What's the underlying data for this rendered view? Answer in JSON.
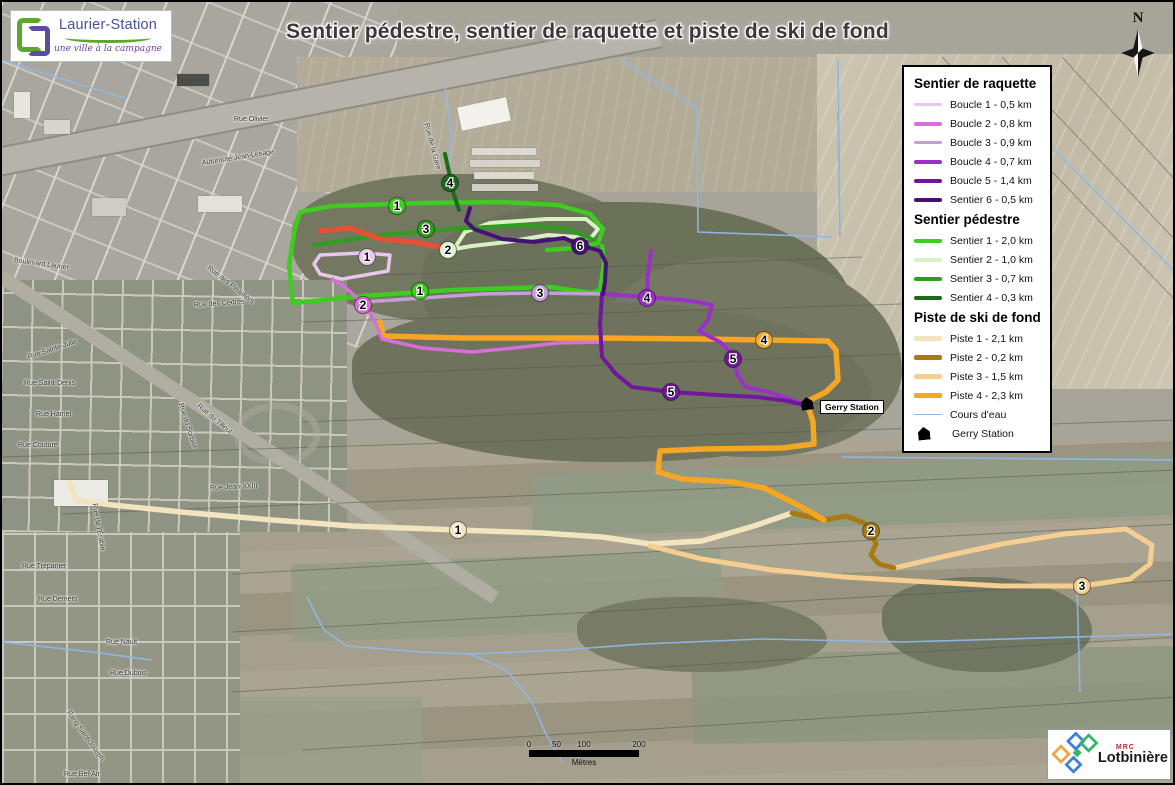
{
  "title": "Sentier pédestre, sentier de raquette et piste de ski de fond",
  "header_logo": {
    "name": "Laurier-Station",
    "tagline": "une ville à la campagne"
  },
  "north_arrow_label": "N",
  "legend": {
    "sections": [
      {
        "heading": "Sentier de raquette",
        "items": [
          {
            "label": "Boucle 1 - 0,5 km",
            "color": "#E8C7EE",
            "weight": 3
          },
          {
            "label": "Boucle 2 - 0,8 km",
            "color": "#D76FD7",
            "weight": 4
          },
          {
            "label": "Boucle 3 - 0,9 km",
            "color": "#C2A0D6",
            "weight": 3
          },
          {
            "label": "Boucle 4 - 0,7 km",
            "color": "#9B30C9",
            "weight": 4
          },
          {
            "label": "Boucle 5 - 1,4 km",
            "color": "#70179E",
            "weight": 4
          },
          {
            "label": "Sentier 6 - 0,5 km",
            "color": "#451177",
            "weight": 4
          }
        ]
      },
      {
        "heading": "Sentier pédestre",
        "items": [
          {
            "label": "Sentier 1 - 2,0 km",
            "color": "#3DCC1F",
            "weight": 4
          },
          {
            "label": "Sentier 2 - 1,0 km",
            "color": "#D8F2C4",
            "weight": 4
          },
          {
            "label": "Sentier 3 - 0,7 km",
            "color": "#2E9E1F",
            "weight": 4
          },
          {
            "label": "Sentier 4 - 0,3 km",
            "color": "#1C6B1C",
            "weight": 4
          }
        ]
      },
      {
        "heading": "Piste de ski de fond",
        "items": [
          {
            "label": "Piste 1 - 2,1 km",
            "color": "#F2E4BE",
            "weight": 5
          },
          {
            "label": "Piste 2 - 0,2 km",
            "color": "#A87A12",
            "weight": 5
          },
          {
            "label": "Piste 3 - 1,5 km",
            "color": "#F5CE90",
            "weight": 5
          },
          {
            "label": "Piste 4 - 2,3 km",
            "color": "#F5A623",
            "weight": 5
          }
        ]
      }
    ],
    "extras": [
      {
        "label": "Cours d'eau",
        "type": "stream-line",
        "color": "#8FB8E8"
      },
      {
        "label": "Gerry Station",
        "type": "station-icon",
        "color": "#000000"
      }
    ]
  },
  "map": {
    "station_label": "Gerry Station",
    "water_color": "#8FB8E8",
    "markers": [
      {
        "label": "1",
        "x": 395,
        "y": 204,
        "color": "#3DCC1F"
      },
      {
        "label": "3",
        "x": 424,
        "y": 227,
        "color": "#2E9E1F"
      },
      {
        "label": "4",
        "x": 448,
        "y": 181,
        "color": "#1C6B1C"
      },
      {
        "label": "2",
        "x": 446,
        "y": 248,
        "color": "#DFF0CE"
      },
      {
        "label": "1",
        "x": 418,
        "y": 289,
        "color": "#3DCC1F"
      },
      {
        "label": "1",
        "x": 365,
        "y": 255,
        "color": "#E8C7EE"
      },
      {
        "label": "2",
        "x": 361,
        "y": 303,
        "color": "#D76FD7"
      },
      {
        "label": "3",
        "x": 538,
        "y": 291,
        "color": "#C2A0D6"
      },
      {
        "label": "6",
        "x": 578,
        "y": 244,
        "color": "#451177"
      },
      {
        "label": "4",
        "x": 645,
        "y": 296,
        "color": "#9B30C9"
      },
      {
        "label": "5",
        "x": 731,
        "y": 357,
        "color": "#70179E"
      },
      {
        "label": "5",
        "x": 669,
        "y": 390,
        "color": "#70179E"
      },
      {
        "label": "4",
        "x": 762,
        "y": 338,
        "color": "#F5A623"
      },
      {
        "label": "1",
        "x": 456,
        "y": 528,
        "color": "#F2E4BE"
      },
      {
        "label": "2",
        "x": 869,
        "y": 529,
        "color": "#A87A12"
      },
      {
        "label": "3",
        "x": 1080,
        "y": 584,
        "color": "#F2CF8E"
      }
    ],
    "street_labels": [
      {
        "text": "Rue Talbot",
        "x": 82,
        "y": 42,
        "rot": 0
      },
      {
        "text": "Rue Olivier",
        "x": 232,
        "y": 114,
        "rot": 0
      },
      {
        "text": "Autoroute Jean-Lesage",
        "x": 200,
        "y": 158,
        "rot": -9
      },
      {
        "text": "Boulevard Laurier",
        "x": 12,
        "y": 255,
        "rot": 8
      },
      {
        "text": "Rue des Peupliers",
        "x": 206,
        "y": 262,
        "rot": 38
      },
      {
        "text": "Rue des Cèdres",
        "x": 192,
        "y": 300,
        "rot": -4
      },
      {
        "text": "Rue Sainte-Julie",
        "x": 26,
        "y": 352,
        "rot": -18
      },
      {
        "text": "Rue Saint-Denis",
        "x": 22,
        "y": 378,
        "rot": 0
      },
      {
        "text": "Rue Hamel",
        "x": 34,
        "y": 409,
        "rot": 0
      },
      {
        "text": "Rue Couture",
        "x": 16,
        "y": 440,
        "rot": 0
      },
      {
        "text": "Rue Jean-XXIII",
        "x": 208,
        "y": 483,
        "rot": -3
      },
      {
        "text": "Rue de l'Érable",
        "x": 92,
        "y": 498,
        "rot": 80
      },
      {
        "text": "Rue du Sorbier",
        "x": 178,
        "y": 398,
        "rot": 72
      },
      {
        "text": "Rue du Tilleul",
        "x": 196,
        "y": 400,
        "rot": 40
      },
      {
        "text": "Rue Trépanier",
        "x": 20,
        "y": 561,
        "rot": 0
      },
      {
        "text": "Rue Demers",
        "x": 36,
        "y": 594,
        "rot": 0
      },
      {
        "text": "Rue Nault",
        "x": 104,
        "y": 637,
        "rot": 0
      },
      {
        "text": "Rue Dubois",
        "x": 108,
        "y": 668,
        "rot": 0
      },
      {
        "text": "Rang Saint-Joseph",
        "x": 66,
        "y": 706,
        "rot": 55
      },
      {
        "text": "Rue Bel-Air",
        "x": 62,
        "y": 769,
        "rot": 0
      },
      {
        "text": "Rue de la Gare",
        "x": 424,
        "y": 118,
        "rot": 75
      }
    ]
  },
  "scale_bar": {
    "ticks": [
      "0",
      "50",
      "100",
      "200"
    ],
    "unit": "Mètres"
  },
  "footer_logo": {
    "org": "MRC",
    "name": "Lotbinière"
  }
}
